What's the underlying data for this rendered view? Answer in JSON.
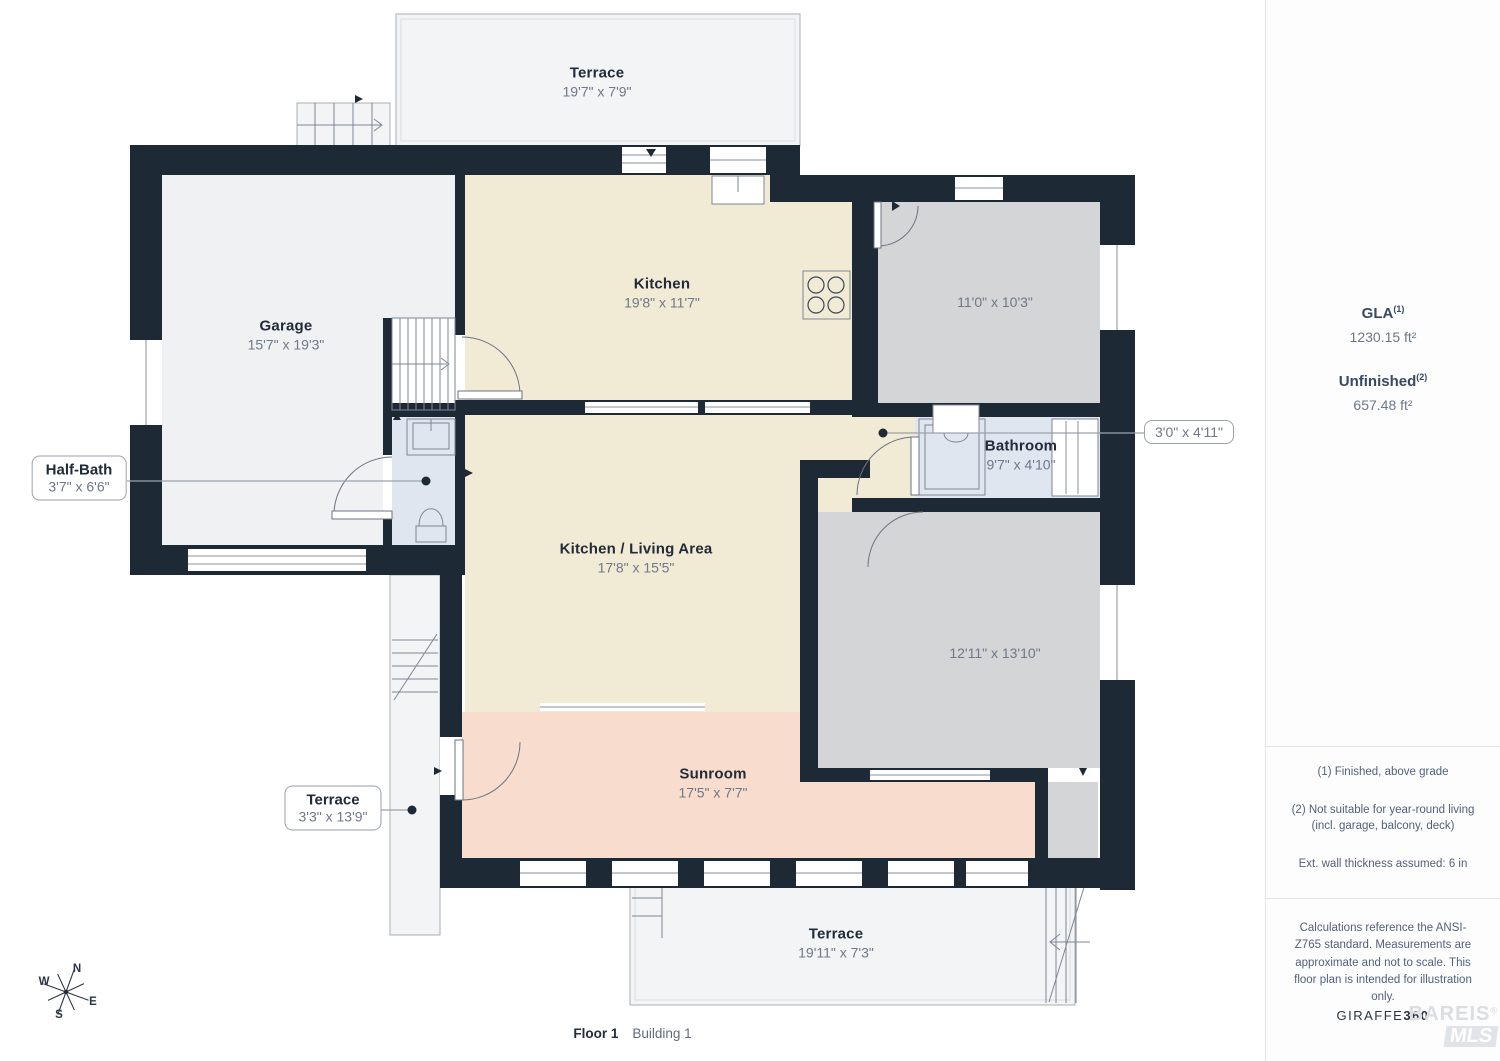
{
  "floor_plan": {
    "rooms": {
      "terrace_top": {
        "name": "Terrace",
        "dims": "19'7\" x 7'9\""
      },
      "garage": {
        "name": "Garage",
        "dims": "15'7\" x 19'3\""
      },
      "kitchen": {
        "name": "Kitchen",
        "dims": "19'8\" x 11'7\""
      },
      "room_top_right": {
        "dims": "11'0\" x 10'3\""
      },
      "bathroom": {
        "name": "Bathroom",
        "dims": "9'7\" x 4'10\""
      },
      "kitchen_living": {
        "name": "Kitchen / Living Area",
        "dims": "17'8\" x 15'5\""
      },
      "room_bottom_right": {
        "dims": "12'11\" x 13'10\""
      },
      "sunroom": {
        "name": "Sunroom",
        "dims": "17'5\" x 7'7\""
      },
      "terrace_bottom": {
        "name": "Terrace",
        "dims": "19'11\" x 7'3\""
      }
    },
    "callouts": {
      "half_bath": {
        "name": "Half-Bath",
        "dims": "3'7\" x 6'6\""
      },
      "terrace_left": {
        "name": "Terrace",
        "dims": "3'3\" x 13'9\""
      },
      "closet": {
        "dims": "3'0\" x 4'11\""
      }
    },
    "compass": {
      "n": "N",
      "e": "E",
      "s": "S",
      "w": "W"
    }
  },
  "sidebar": {
    "gla": {
      "label": "GLA",
      "sup": "(1)",
      "value": "1230.15 ft²"
    },
    "unfinished": {
      "label": "Unfinished",
      "sup": "(2)",
      "value": "657.48 ft²"
    },
    "notes": [
      "(1) Finished, above grade",
      "(2) Not suitable for year-round living (incl. garage, balcony, deck)",
      "Ext. wall thickness assumed: 6 in"
    ],
    "disclaimer": "Calculations reference the ANSI-Z765 standard. Measurements are approximate and not to scale. This floor plan is intended for illustration only.",
    "logo": {
      "part1": "GIRAFFE",
      "part2": "360"
    },
    "watermark": {
      "line1": "BAREIS",
      "reg": "®",
      "line2": "MLS"
    }
  },
  "footer": {
    "floor": "Floor 1",
    "building": "Building 1"
  },
  "palette": {
    "wall": "#1e2936",
    "kitchen": "#f1ead5",
    "sunroom": "#f8dccd",
    "gray_room": "#d4d5d7",
    "bath": "#e0e6f0",
    "terrace": "#f3f4f6"
  }
}
